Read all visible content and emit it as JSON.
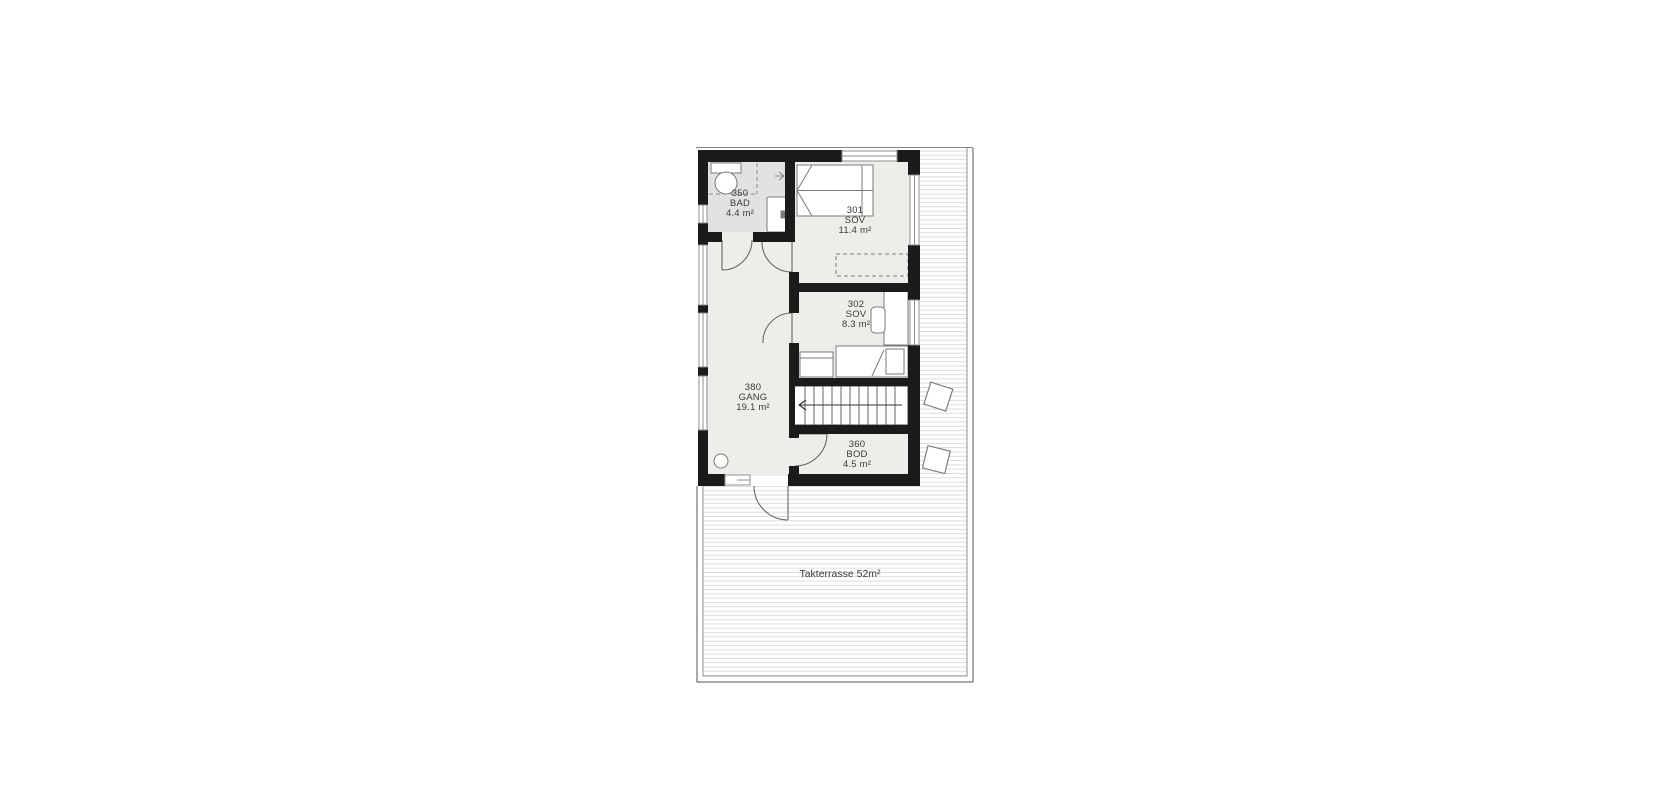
{
  "plan": {
    "rooms": [
      {
        "id": "bad",
        "number": "350",
        "name": "BAD",
        "area": "4.4 m²"
      },
      {
        "id": "sov1",
        "number": "301",
        "name": "SOV",
        "area": "11.4 m²"
      },
      {
        "id": "sov2",
        "number": "302",
        "name": "SOV",
        "area": "8.3 m²"
      },
      {
        "id": "gang",
        "number": "380",
        "name": "GANG",
        "area": "19.1 m²"
      },
      {
        "id": "bod",
        "number": "360",
        "name": "BOD",
        "area": "4.5 m²"
      }
    ],
    "terrace": {
      "label": "Takterrasse 52m²"
    },
    "colors": {
      "wall": "#1b1b1b",
      "floor": "#edede9",
      "bathroom_floor": "#e2e2e0",
      "deck_line": "#dcdcdc",
      "symbol_outline": "#777777",
      "text": "#3a3a3a"
    }
  }
}
